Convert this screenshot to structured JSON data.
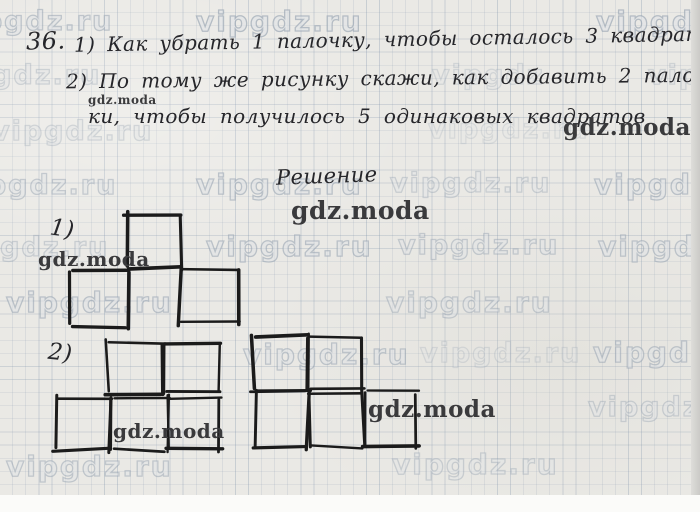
{
  "page": {
    "paper_color": "#eae9e5",
    "grid_color": "#8ea2bc",
    "ink_color": "#26262a",
    "stick_color": "#1b1b1b",
    "watermark_dark_color": "#3a3a3c",
    "watermark_faint_outline": "#909caC"
  },
  "problem": {
    "number": "36.",
    "line1": "1) Как убрать 1 палочку, чтобы осталось 3 квадрата?",
    "line2": "2) По тому же рисунку скажи, как добавить 2 палоч-",
    "line3": "ки, чтобы получилось 5 одинаковых квадратов",
    "solution_heading": "Решение",
    "figure1_label": "1)",
    "figure2_label": "2)"
  },
  "watermarks": {
    "faint": [
      {
        "text": "vipgdz.ru",
        "x": -48,
        "y": 6,
        "size": 27,
        "opacity": 0.8
      },
      {
        "text": "vipgdz.ru",
        "x": 196,
        "y": 5,
        "size": 28,
        "opacity": 0.95
      },
      {
        "text": "vipgdz",
        "x": 596,
        "y": 5,
        "size": 28,
        "opacity": 0.95
      },
      {
        "text": "vipgdz.ru",
        "x": -60,
        "y": 60,
        "size": 27,
        "opacity": 0.55
      },
      {
        "text": "vipgdz",
        "x": 432,
        "y": 60,
        "size": 27,
        "opacity": 0.45
      },
      {
        "text": "vipgdz",
        "x": 648,
        "y": 60,
        "size": 27,
        "opacity": 0.5
      },
      {
        "text": "vipgdz.ru",
        "x": -8,
        "y": 116,
        "size": 27,
        "opacity": 0.5
      },
      {
        "text": "vipgdz.ru",
        "x": 428,
        "y": 114,
        "size": 27,
        "opacity": 0.35
      },
      {
        "text": "vipgdz.ru",
        "x": -44,
        "y": 170,
        "size": 27,
        "opacity": 0.7
      },
      {
        "text": "vipgdz.ru",
        "x": 196,
        "y": 168,
        "size": 28,
        "opacity": 0.85
      },
      {
        "text": "vipgdz.ru",
        "x": 390,
        "y": 168,
        "size": 27,
        "opacity": 0.6
      },
      {
        "text": "vipgdz",
        "x": 594,
        "y": 168,
        "size": 28,
        "opacity": 0.85
      },
      {
        "text": "vipgdz.ru",
        "x": -52,
        "y": 232,
        "size": 27,
        "opacity": 0.6
      },
      {
        "text": "vipgdz.ru",
        "x": 206,
        "y": 230,
        "size": 28,
        "opacity": 0.85
      },
      {
        "text": "vipgdz.ru",
        "x": 398,
        "y": 230,
        "size": 27,
        "opacity": 0.7
      },
      {
        "text": "vipgdz",
        "x": 598,
        "y": 230,
        "size": 28,
        "opacity": 0.8
      },
      {
        "text": "vipgdz.ru",
        "x": 6,
        "y": 286,
        "size": 28,
        "opacity": 0.85
      },
      {
        "text": "vipgdz.ru",
        "x": 386,
        "y": 286,
        "size": 28,
        "opacity": 0.7
      },
      {
        "text": "vipgdz.ru",
        "x": 243,
        "y": 338,
        "size": 28,
        "opacity": 0.8
      },
      {
        "text": "vipgdz.ru",
        "x": 420,
        "y": 338,
        "size": 27,
        "opacity": 0.4
      },
      {
        "text": "vipgdz",
        "x": 593,
        "y": 336,
        "size": 28,
        "opacity": 0.8
      },
      {
        "text": "vipgdz",
        "x": 588,
        "y": 392,
        "size": 27,
        "opacity": 0.6
      },
      {
        "text": "vipgdz.ru",
        "x": 6,
        "y": 450,
        "size": 28,
        "opacity": 0.75
      },
      {
        "text": "vipgdz.ru",
        "x": 392,
        "y": 448,
        "size": 28,
        "opacity": 0.6
      }
    ],
    "dark": [
      {
        "text": "gdz.moda",
        "x": 88,
        "y": 93,
        "size": 12
      },
      {
        "text": "gdz.moda",
        "x": 563,
        "y": 114,
        "size": 23
      },
      {
        "text": "gdz.moda",
        "x": 291,
        "y": 196,
        "size": 25
      },
      {
        "text": "gdz.moda",
        "x": 38,
        "y": 247,
        "size": 20
      },
      {
        "text": "gdz.moda",
        "x": 113,
        "y": 419,
        "size": 20
      },
      {
        "text": "gdz.moda",
        "x": 368,
        "y": 396,
        "size": 23
      }
    ]
  },
  "figures": {
    "fig1_three_squares": {
      "squares": [
        {
          "x": 126,
          "y": 214,
          "w": 54,
          "h": 54
        },
        {
          "x": 71,
          "y": 270,
          "w": 56,
          "h": 56
        },
        {
          "x": 180,
          "y": 268,
          "w": 57,
          "h": 55
        }
      ]
    },
    "fig2_left_five_squares": {
      "squares": [
        {
          "x": 107,
          "y": 342,
          "w": 56,
          "h": 51
        },
        {
          "x": 164,
          "y": 342,
          "w": 54,
          "h": 51
        },
        {
          "x": 55,
          "y": 397,
          "w": 55,
          "h": 53
        },
        {
          "x": 112,
          "y": 397,
          "w": 55,
          "h": 53
        },
        {
          "x": 168,
          "y": 397,
          "w": 52,
          "h": 53
        }
      ]
    },
    "fig2_right_five_squares": {
      "squares": [
        {
          "x": 253,
          "y": 336,
          "w": 54,
          "h": 54
        },
        {
          "x": 308,
          "y": 336,
          "w": 55,
          "h": 54
        },
        {
          "x": 255,
          "y": 392,
          "w": 53,
          "h": 55
        },
        {
          "x": 310,
          "y": 392,
          "w": 53,
          "h": 55
        },
        {
          "x": 365,
          "y": 392,
          "w": 52,
          "h": 55
        }
      ]
    }
  }
}
